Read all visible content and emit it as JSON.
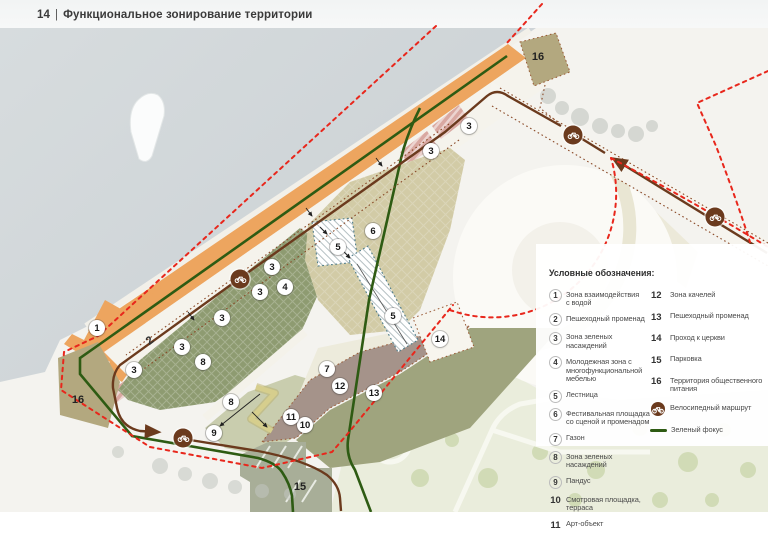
{
  "header": {
    "page_number": "14",
    "divider": "|",
    "title": "Функциональное зонирование территории"
  },
  "legend": {
    "heading": "Условные обозначения:",
    "column1": [
      {
        "num": "1",
        "label": "Зона взаимодействия\nс водой",
        "circled": true
      },
      {
        "num": "2",
        "label": "Пешеходный променад",
        "circled": true
      },
      {
        "num": "3",
        "label": "Зона зеленых\nнасаждений",
        "circled": true
      },
      {
        "num": "4",
        "label": "Молодежная зона с\nмногофункциональной\nмебелью",
        "circled": true
      },
      {
        "num": "5",
        "label": "Лестница",
        "circled": true
      },
      {
        "num": "6",
        "label": "Фестивальная площадка\nсо сценой и променадом",
        "circled": true
      },
      {
        "num": "7",
        "label": "Газон",
        "circled": true
      },
      {
        "num": "8",
        "label": "Зона зеленых насаждений",
        "circled": true
      },
      {
        "num": "9",
        "label": "Пандус",
        "circled": true
      },
      {
        "num": "10",
        "label": "Смотровая площадка,\nтерраса",
        "circled": false
      },
      {
        "num": "11",
        "label": "Арт-объект",
        "circled": false
      }
    ],
    "column2": [
      {
        "num": "12",
        "label": "Зона качелей"
      },
      {
        "num": "13",
        "label": "Пешеходный променад"
      },
      {
        "num": "14",
        "label": "Проход к церкви"
      },
      {
        "num": "15",
        "label": "Парковка"
      },
      {
        "num": "16",
        "label": "Территория общественного\nпитания"
      }
    ],
    "route_items": [
      {
        "icon": "bike-route-icon",
        "label": "Велосипедный маршрут"
      },
      {
        "icon": "green-focus-line",
        "label": "Зеленый фокус"
      }
    ]
  },
  "map": {
    "markers": [
      {
        "n": "1",
        "x": 97,
        "y": 328
      },
      {
        "n": "2",
        "x": 150,
        "y": 341,
        "style": "rotated"
      },
      {
        "n": "3",
        "x": 272,
        "y": 267
      },
      {
        "n": "3",
        "x": 260,
        "y": 292
      },
      {
        "n": "3",
        "x": 222,
        "y": 318
      },
      {
        "n": "3",
        "x": 182,
        "y": 347
      },
      {
        "n": "3",
        "x": 134,
        "y": 370
      },
      {
        "n": "3",
        "x": 469,
        "y": 126
      },
      {
        "n": "3",
        "x": 431,
        "y": 151
      },
      {
        "n": "4",
        "x": 285,
        "y": 287
      },
      {
        "n": "5",
        "x": 338,
        "y": 247
      },
      {
        "n": "5",
        "x": 393,
        "y": 316
      },
      {
        "n": "6",
        "x": 373,
        "y": 231
      },
      {
        "n": "7",
        "x": 327,
        "y": 369
      },
      {
        "n": "8",
        "x": 203,
        "y": 362
      },
      {
        "n": "8",
        "x": 231,
        "y": 402
      },
      {
        "n": "9",
        "x": 214,
        "y": 433
      },
      {
        "n": "10",
        "x": 305,
        "y": 425
      },
      {
        "n": "11",
        "x": 291,
        "y": 417
      },
      {
        "n": "12",
        "x": 340,
        "y": 386
      },
      {
        "n": "13",
        "x": 374,
        "y": 393
      },
      {
        "n": "14",
        "x": 440,
        "y": 339
      },
      {
        "n": "15",
        "x": 300,
        "y": 487,
        "style": "plain"
      },
      {
        "n": "16",
        "x": 78,
        "y": 400,
        "style": "plain"
      },
      {
        "n": "16",
        "x": 538,
        "y": 57,
        "style": "plain"
      }
    ],
    "bike_icons": [
      {
        "x": 240,
        "y": 279
      },
      {
        "x": 183,
        "y": 438
      },
      {
        "x": 573,
        "y": 135
      },
      {
        "x": 715,
        "y": 217
      }
    ],
    "colors": {
      "water": "#d3d8da",
      "embankment_orange": "#eda55f",
      "promenade": "#f5f3ec",
      "green_zone": "#8e9b71",
      "festival_beige": "#d2cba6",
      "lawn": "#edebdc",
      "mauve": "#a5938a",
      "olive_band": "#9fa47e",
      "public_food": "#b3a87f",
      "parking": "#a8ae98",
      "park": "#eaeddc",
      "ramp_yellow": "#d6ce8d",
      "route_brown": "#6b3a1d",
      "green_focus": "#2e5b13",
      "boundary_red": "#e8271c",
      "pink_plantings": "#d9a8a1"
    }
  }
}
